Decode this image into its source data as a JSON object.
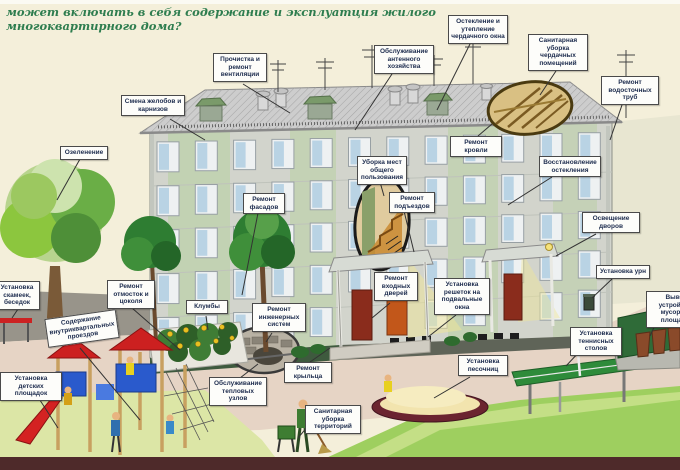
{
  "title": "может включать в себя содержание и эксплуатция жилого многоквартирного дома?",
  "labels": {
    "gutters": "Смена желобов и карнизов",
    "vents": "Прочистка и ремонт вентиляции",
    "antenna": "Обслуживание антенного хозяйства",
    "attic_window": "Остекление и утепление чердачного окна",
    "attic_clean": "Санитарная уборка чердачных помещений",
    "downpipes": "Ремонт водосточных труб",
    "greening": "Озеленение",
    "facades": "Ремонт фасадов",
    "common_areas": "Уборка мест общего пользования",
    "entrances": "Ремонт подъездов",
    "roof_repair": "Ремонт кровли",
    "reglazing": "Восстановление остекления",
    "yard_light": "Освещение дворов",
    "urns": "Установка урн",
    "garbage": "Вывоз, устройство мусорных площадок",
    "benches": "Установка скамеек, беседок",
    "blind_area": "Ремонт отмосток и цоколя",
    "driveways": "Содержание внутриквартальных проездов",
    "flowerbeds": "Клумбы",
    "eng_systems": "Ремонт инженерных систем",
    "doors": "Ремонт входных дверей",
    "grilles": "Установка решеток на подвальные окна",
    "playgrounds": "Установка детских площадок",
    "heat_units": "Обслуживание тепловых узлов",
    "porch": "Ремонт крыльца",
    "territory": "Санитарная уборка территорий",
    "sandboxes": "Установка песочниц",
    "tennis": "Установка теннисных столов"
  },
  "colors": {
    "background": "#f4efda",
    "title_text": "#2e7d4f",
    "roof": "#cdcdcd",
    "facade": "#d2d4cc",
    "panel_green": "#b5cf9e",
    "pavement": "#e6d4c5",
    "lawn_bright": "#9ecf5f",
    "lawn_pale": "#dce6a6",
    "footer_bar": "#4e2a2a"
  }
}
